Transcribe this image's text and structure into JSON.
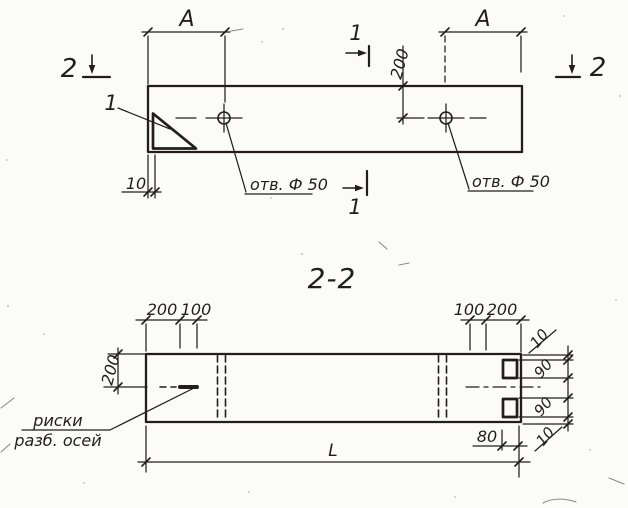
{
  "colors": {
    "ink": "#221f1a",
    "paper": "#fbfbf8"
  },
  "elevation": {
    "dim_a_left": "A",
    "dim_a_right": "A",
    "dim_depth_200": "200",
    "dim_wall_10": "10",
    "hole_label_left": "отв. Ф 50",
    "hole_label_right": "отв. Ф 50",
    "detail_ref": "1",
    "section_mark_1_top": "1",
    "section_mark_1_bottom": "1",
    "section_mark_2_left": "2",
    "section_mark_2_right": "2"
  },
  "section_2_2": {
    "title": "2-2",
    "dim_left_edge_200": "200",
    "dim_left_riska_100": "100",
    "dim_right_riska_100": "100",
    "dim_right_edge_200": "200",
    "dim_side_200": "200",
    "dim_notch_10_top": "10",
    "dim_notch_90_top": "90",
    "dim_notch_90_bottom": "90",
    "dim_notch_10_bottom": "10",
    "dim_80": "80",
    "dim_length": "L",
    "axis_note_line1": "риски",
    "axis_note_line2": "разб. осей"
  }
}
